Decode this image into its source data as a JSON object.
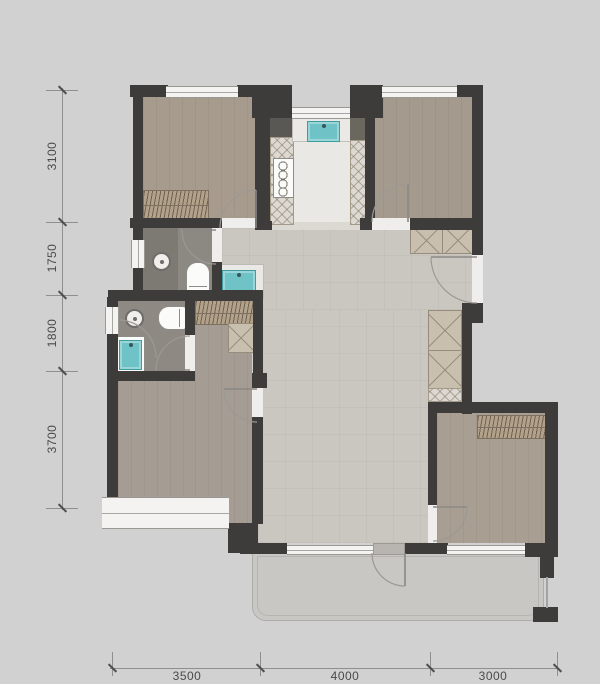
{
  "title": "apartment-floor-plan",
  "dimensions": {
    "left": [
      {
        "label": "3100"
      },
      {
        "label": "1750"
      },
      {
        "label": "1800"
      },
      {
        "label": "3700"
      }
    ],
    "bottom": [
      {
        "label": "3500"
      },
      {
        "label": "4000"
      },
      {
        "label": "3000"
      }
    ]
  },
  "colors": {
    "background": "#d1d1d1",
    "wall": "#3e3c3a",
    "bedroom_floor": "#a79b8e",
    "living_floor": "#cac7c1",
    "kitchen_floor": "#e9e8e4",
    "bathroom_floor": "#8b8782",
    "balcony_floor": "#c8c7c3",
    "fixture_teal": "#6fc2c6",
    "wardrobe": "#b2a28c",
    "window_white": "#f4f3f1"
  }
}
